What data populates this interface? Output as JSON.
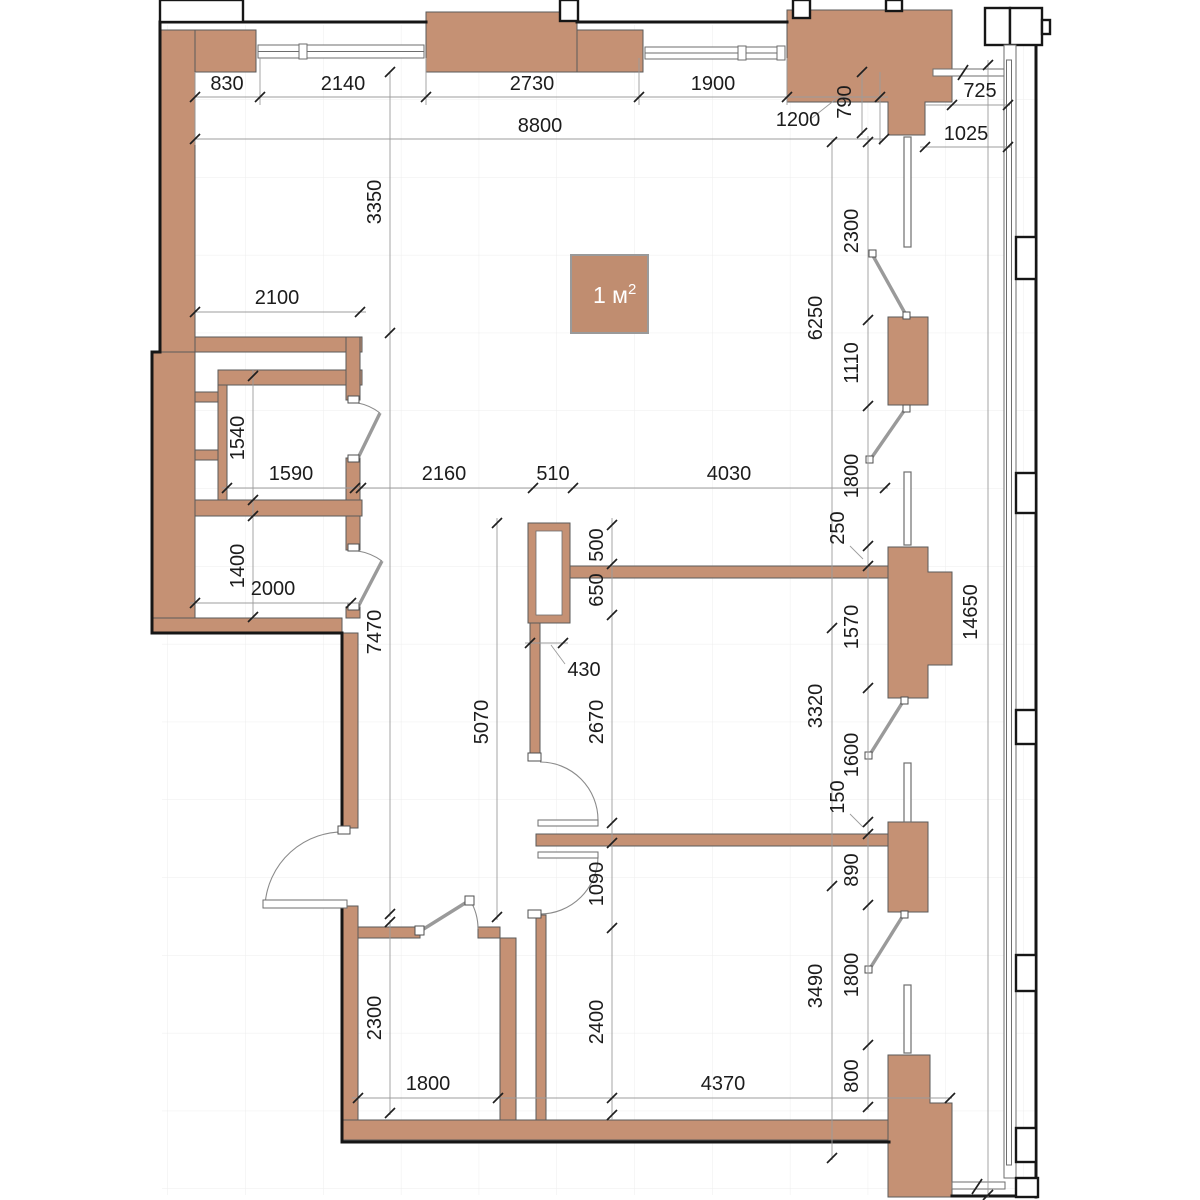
{
  "drawing": {
    "type": "apartment floor plan",
    "units": "mm",
    "wall_color": "#c59174",
    "line_color": "#161616"
  },
  "legend": {
    "base": "1 м",
    "sup": "2"
  },
  "dims": {
    "top": [
      "830",
      "2140",
      "2730",
      "1900",
      "1200",
      "790",
      "8800",
      "725",
      "1025"
    ],
    "left": [
      "3350",
      "2100",
      "1540",
      "1590",
      "1400",
      "2000",
      "7470",
      "2300",
      "1800"
    ],
    "mid": [
      "2160",
      "510",
      "4030",
      "5070",
      "500",
      "650",
      "430",
      "2670",
      "1090",
      "2400",
      "4370"
    ],
    "right_a": [
      "6250",
      "3320",
      "3490",
      "14650"
    ],
    "right_b": [
      "2300",
      "1110",
      "1800",
      "250",
      "1570",
      "1600",
      "150",
      "890",
      "1800",
      "800"
    ]
  }
}
